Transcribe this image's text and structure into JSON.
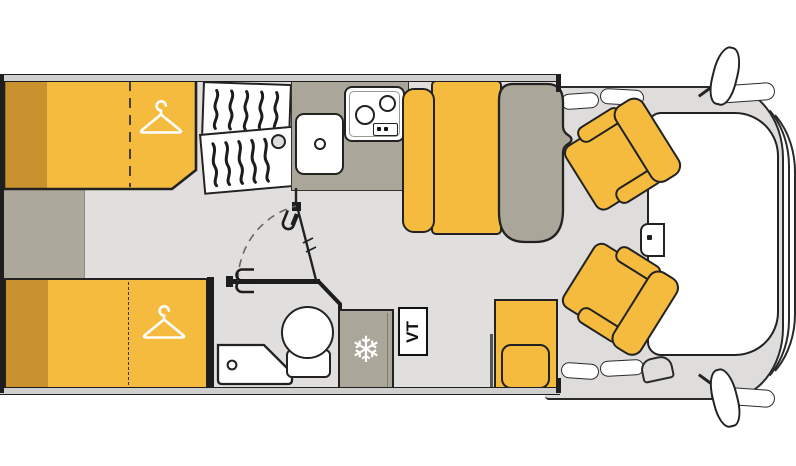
{
  "diagram": {
    "type": "motorhome-floorplan-top-view",
    "labels": {
      "tv": "TV"
    },
    "icons": {
      "snowflake": "❄",
      "hanger_count": 2,
      "stove_burners": 2
    },
    "colors": {
      "furniture_yellow": "#F5BB3F",
      "furniture_yellow_dark": "#C9922F",
      "surface_olive": "#AAA699",
      "floor_grey": "#E0DFDD",
      "cab_grey": "#DEDDDB",
      "outline": "#222222",
      "background": "#FFFFFF"
    },
    "areas": [
      "rear-bed-top",
      "rear-bed-bottom",
      "wardrobe",
      "kitchen",
      "bathroom",
      "shower",
      "toilet",
      "fridge",
      "tv",
      "dinette",
      "table",
      "rear-bench",
      "cab-seat-top",
      "cab-seat-bottom",
      "windshield"
    ]
  }
}
